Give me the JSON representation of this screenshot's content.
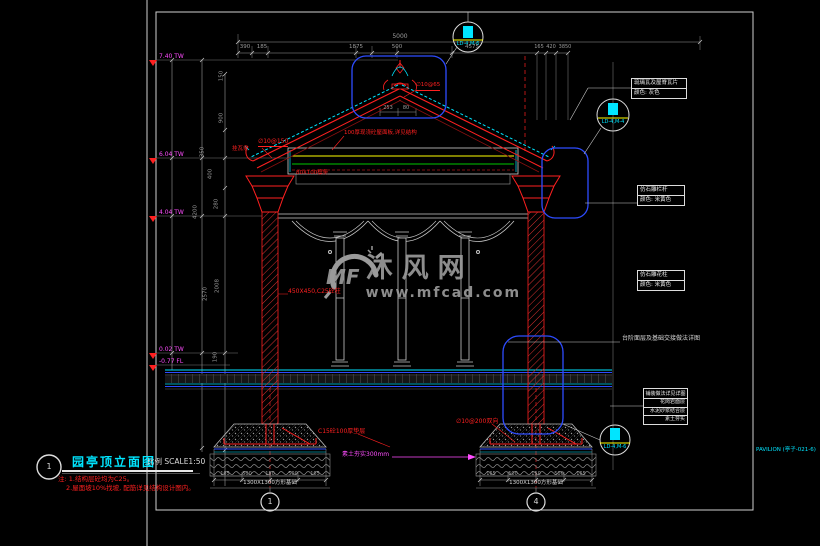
{
  "sheet": {
    "ref": "PAVILION (亭子-021-6)"
  },
  "title_block": {
    "number": "1",
    "title": "园亭顶立面图",
    "scale": "比例 SCALE1:50",
    "note_line1": "注: 1.结构层砼均为C25。",
    "note_line2": "2.屋面坡10%找坡, 配筋详见结构设计图内。"
  },
  "watermark": {
    "logo": "MF",
    "name": "沐风网",
    "url": "www.mfcad.com"
  },
  "callouts": {
    "top": "LD-4,M-6",
    "right": "LD-4,M-4",
    "bottom_right": "LD-4,M-6"
  },
  "material_labels": {
    "roof_tile_line1": "琉璃瓦及屋脊瓦片",
    "roof_tile_line2": "颜色: 灰色",
    "railing_line1": "仿石雕栏杆",
    "railing_line2": "颜色: 米黄色",
    "column_line1": "仿石雕花柱",
    "column_line2": "颜色: 米黄色",
    "base_note": "台阶面层及基础交接做法详图",
    "paving_header": "铺装做法详见详图",
    "paving_rows": [
      "花岗岩面层",
      "水泥砂浆结合层",
      "素土夯实"
    ]
  },
  "red_labels": {
    "roof_rebar": "∅10@150",
    "tile_batten": "挂瓦条",
    "roof_slab": "100厚现浇砼屋面板,详见结构",
    "purlin": "80X100檩条",
    "ridge_rebar": "∅10@65",
    "column_spec": "450X450,C25砼柱",
    "cushion": "C15砼100厚垫层",
    "footing_rebar": "∅10@200双向",
    "subgrade": "素土夯实300mm"
  },
  "elevation_markers": [
    "7.40 TW",
    "6.04 TW",
    "4.04 TW",
    "0.02 TW",
    "-0.77 FL"
  ],
  "dims": {
    "top_total": "5000",
    "top_row": [
      "390",
      "185",
      "1875",
      "500",
      "4575"
    ],
    "right_cluster": [
      "165",
      "420",
      "3850"
    ],
    "apex": [
      "253",
      "80"
    ],
    "left_chain": [
      "150",
      "900",
      "350",
      "400",
      "280",
      "4200",
      "2570",
      "2008",
      "190"
    ],
    "footing_segments": [
      "165",
      "500",
      "150",
      "500",
      "165"
    ],
    "footing_total_left": "1300X1300方形基础",
    "footing_total_right": "1300X1300方形基础"
  },
  "grid_bubbles": {
    "left": "1",
    "right": "4"
  },
  "colors": {
    "line_red": "#ff2020",
    "line_cyan": "#00e5ff",
    "line_blue": "#2e4cff",
    "line_yellow": "#ffff00",
    "line_green": "#00c800",
    "line_magenta": "#ff4dff",
    "bg": "#000000",
    "watermark": "#9a9a9a"
  }
}
